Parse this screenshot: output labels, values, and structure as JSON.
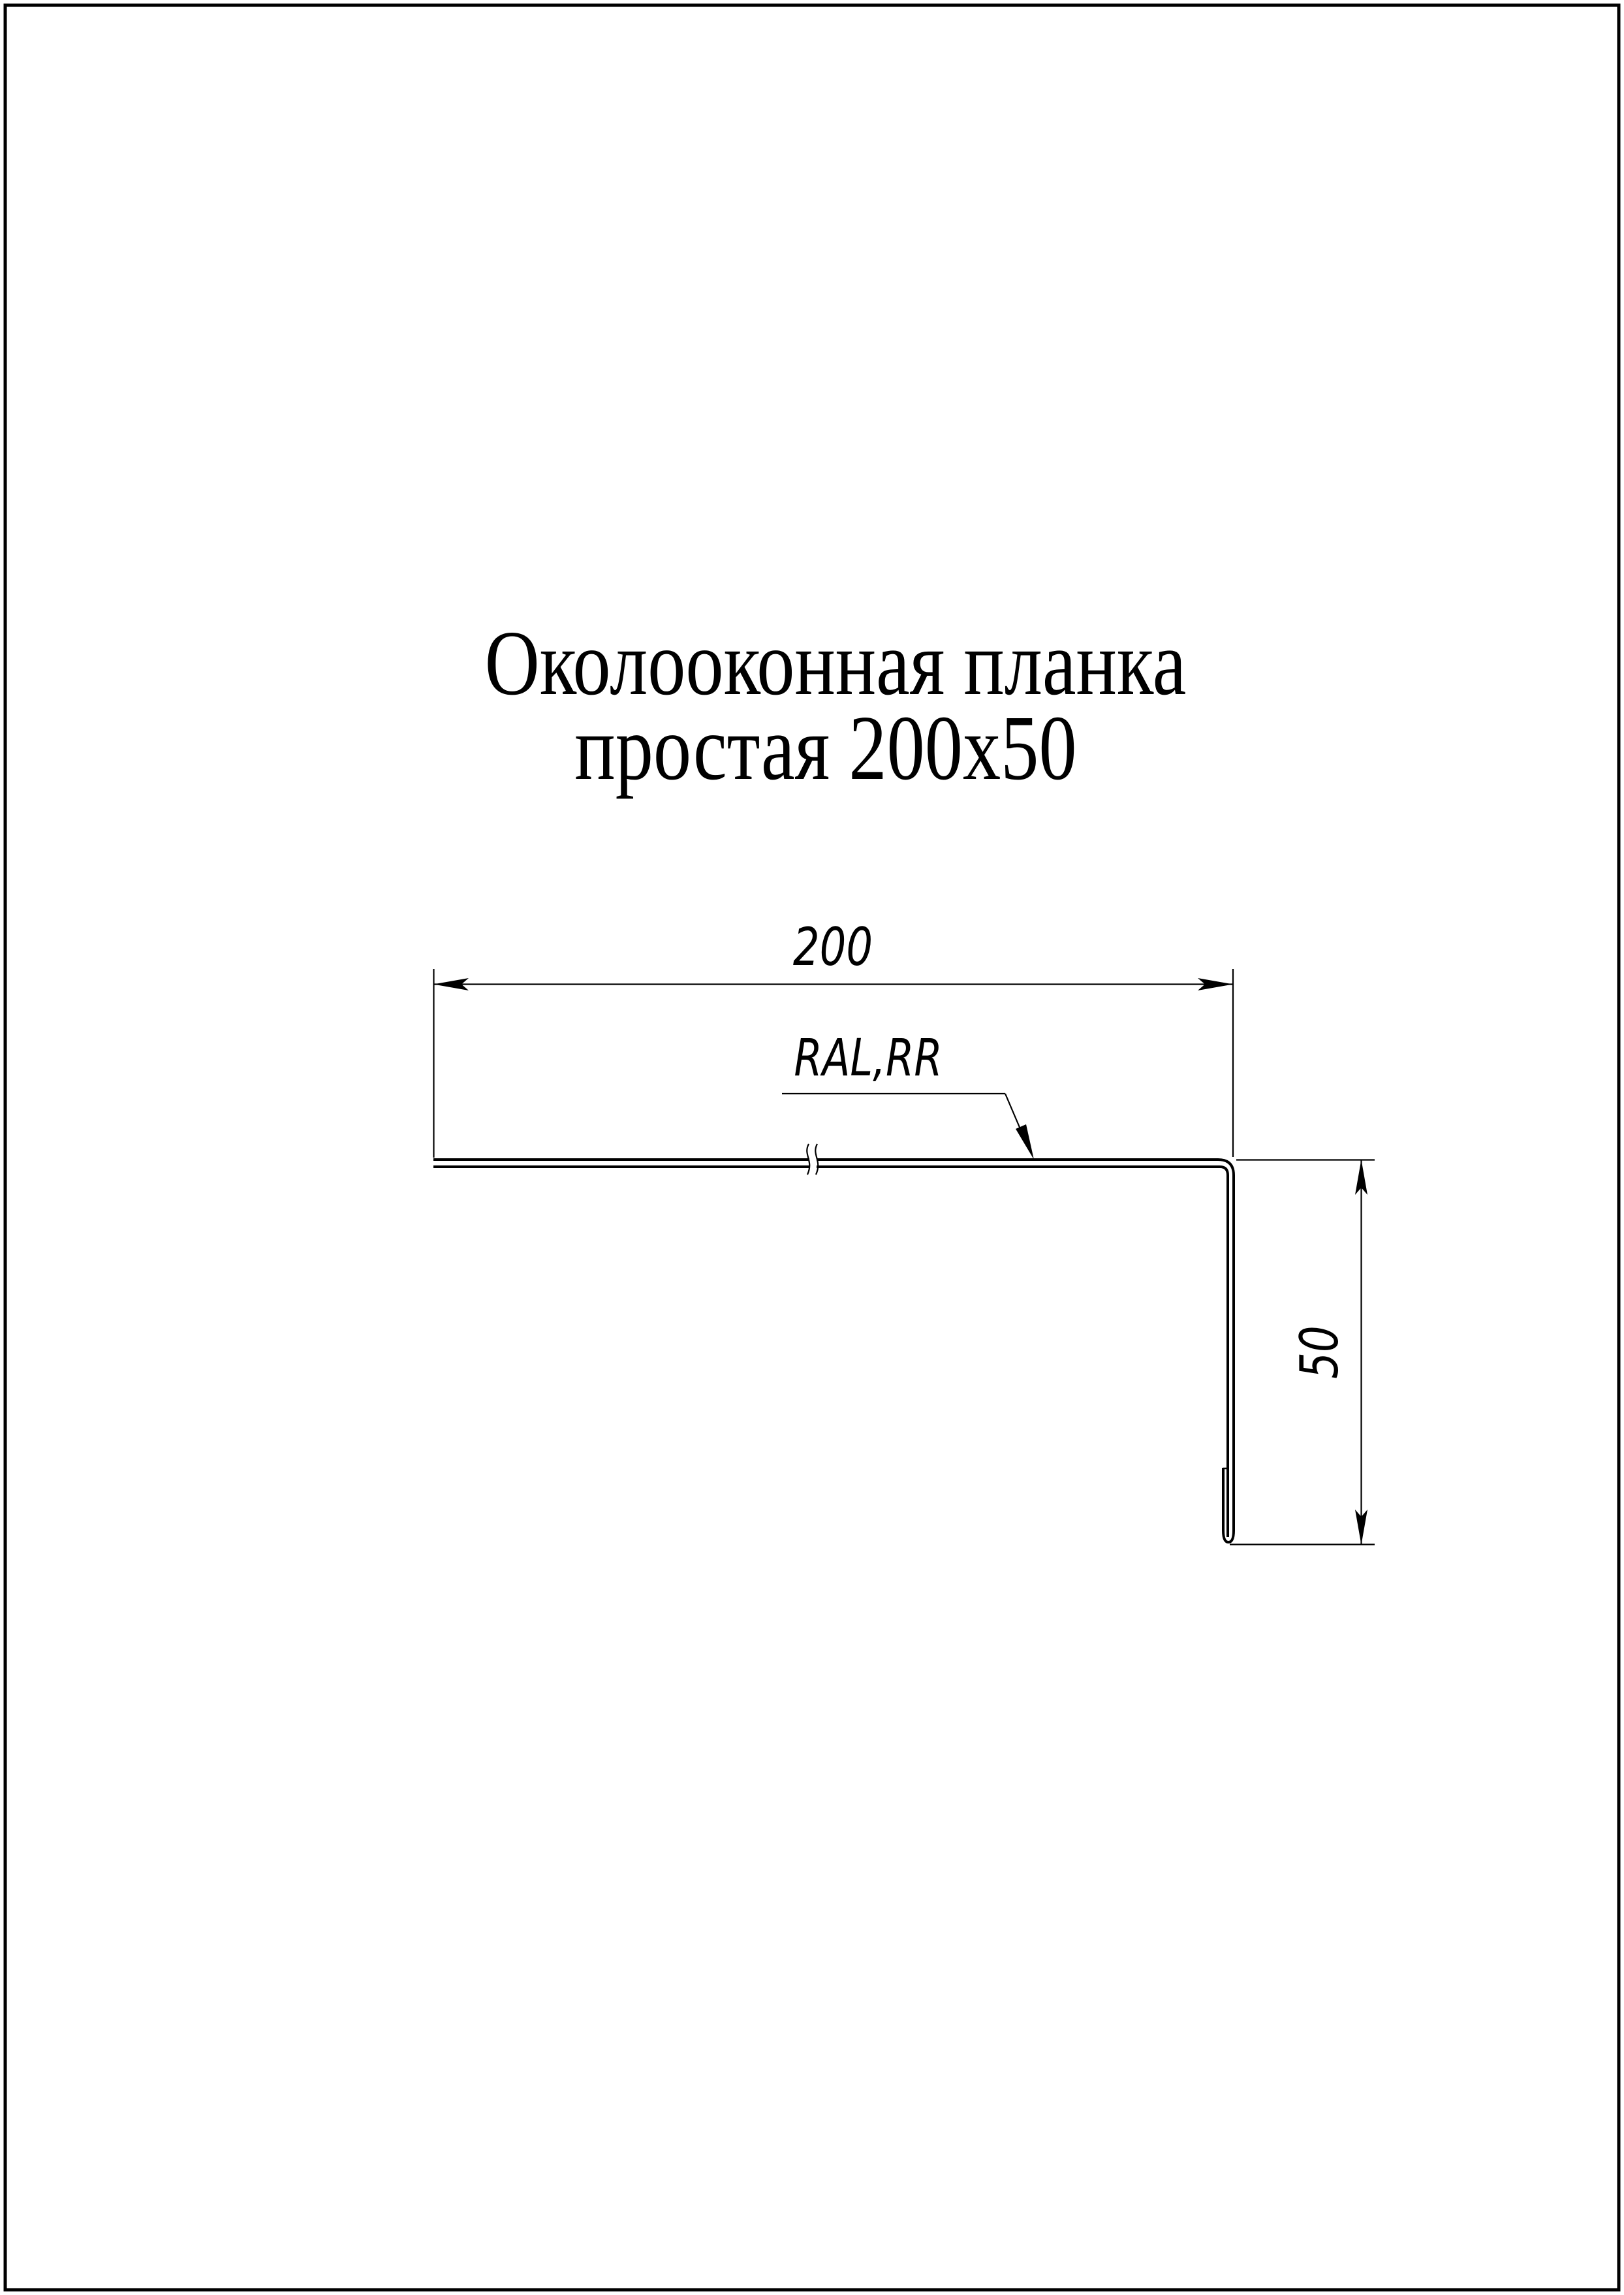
{
  "page": {
    "background_color": "#ffffff",
    "ink_color": "#000000"
  },
  "title": {
    "line1": "Околооконная планка",
    "line2": "простая 200x50"
  },
  "dimensions": {
    "width": {
      "value": "200"
    },
    "height": {
      "value": "50"
    }
  },
  "annotations": {
    "coating": {
      "value": "RAL,RR"
    }
  }
}
